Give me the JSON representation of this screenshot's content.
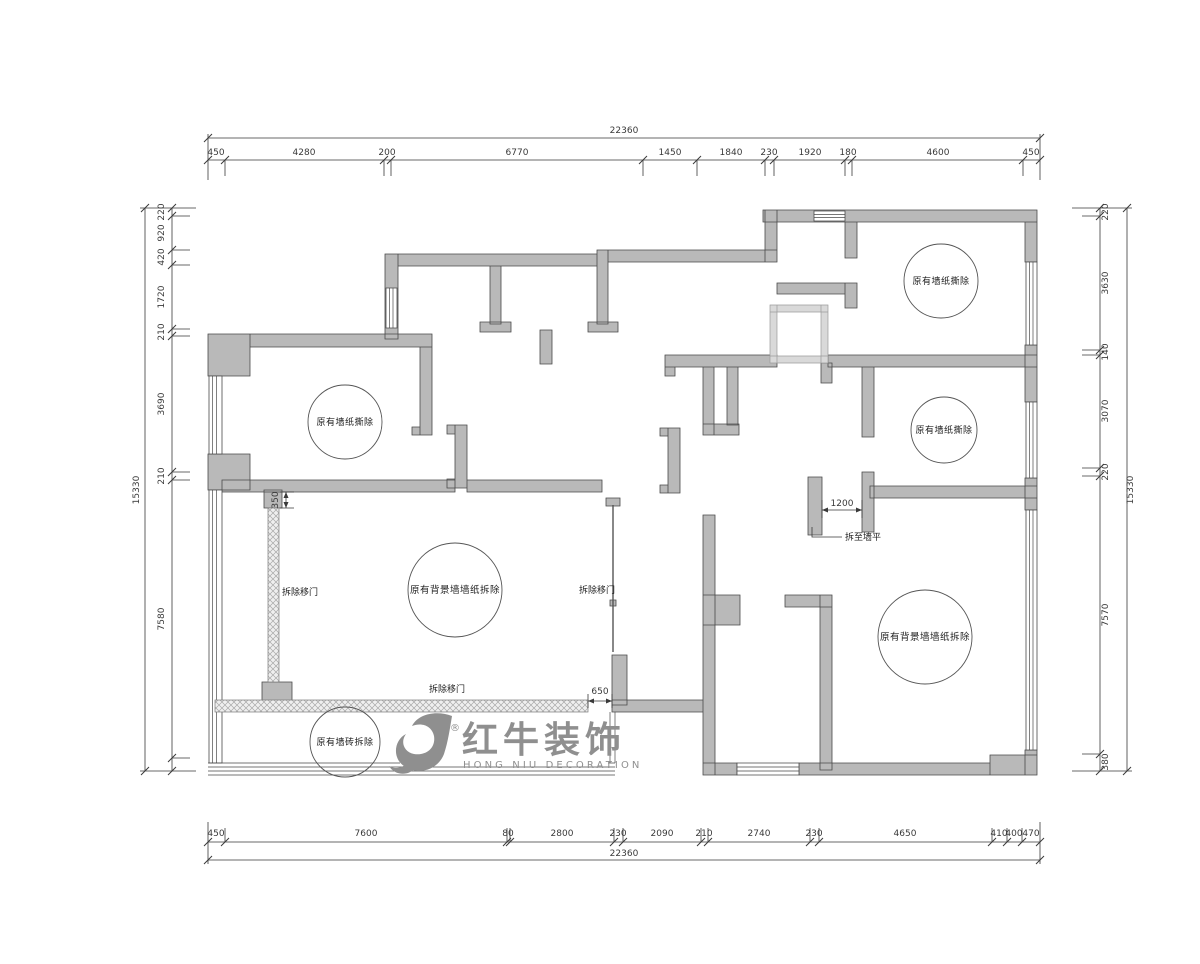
{
  "drawing": {
    "labels": {
      "wallpaper_removal": "原有墙纸撕除",
      "background_wall_wallpaper_removal": "原有背景墙墙纸拆除",
      "wall_tile_removal": "原有墙砖拆除",
      "remove_sliding_door": "拆除移门",
      "demolish_to_wall_level": "拆至墙平",
      "dim_350": "350",
      "dim_650": "650",
      "dim_1200": "1200"
    },
    "dimensions": {
      "top": {
        "total": "22360",
        "segments": [
          "450",
          "4280",
          "200",
          "6770",
          "1450",
          "1840",
          "230",
          "1920",
          "180",
          "4600",
          "450"
        ]
      },
      "bottom": {
        "total": "22360",
        "segments": [
          "450",
          "7600",
          "80",
          "2800",
          "230",
          "2090",
          "210",
          "2740",
          "230",
          "4650",
          "410",
          "400",
          "470"
        ]
      },
      "left": {
        "total": "15330",
        "segments": [
          "220",
          "920",
          "420",
          "1720",
          "210",
          "3690",
          "210",
          "7580"
        ]
      },
      "right": {
        "total": "15330",
        "segments": [
          "220",
          "3630",
          "140",
          "3070",
          "220",
          "7570",
          "380"
        ]
      }
    },
    "colors": {
      "wall_fill": "#b9b9b9",
      "wall_stroke": "#4a4a4a",
      "light_wall": "#d9d9d9",
      "logo_gray": "#8f8f8f"
    },
    "logo": {
      "zh": "红牛装饰",
      "en": "HONG NIU DECORATION",
      "registered": "®"
    }
  }
}
